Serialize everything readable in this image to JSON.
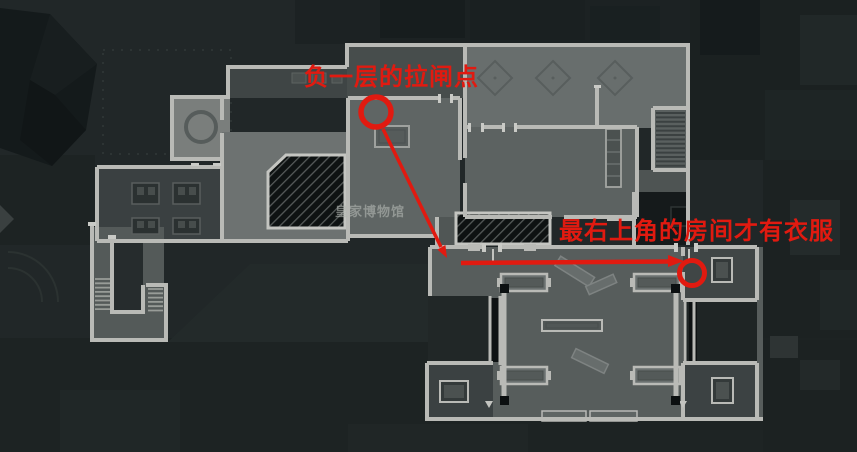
{
  "watermark": {
    "text": "皇家博物馆"
  },
  "annotations": {
    "power_breaker_label": "负一层的拉闸点",
    "clothes_room_label": "最右上角的房间才有衣服"
  },
  "colors": {
    "annotation-red": "#e11a10",
    "watermark-gray": "rgba(178,183,177,0.62)",
    "wall-light": "#b9bab6",
    "bg-dark": "#212728"
  }
}
